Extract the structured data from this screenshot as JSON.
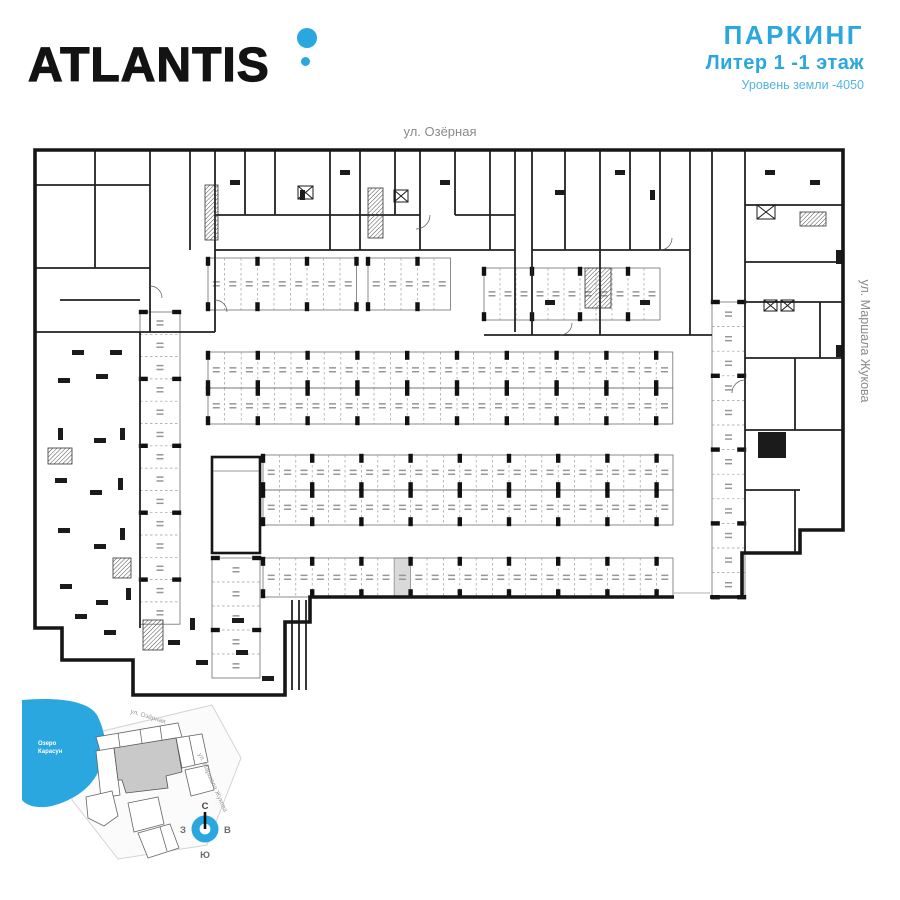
{
  "logo": {
    "text": "ATLANTIS"
  },
  "header": {
    "title": "ПАРКИНГ",
    "subtitle": "Литер 1  -1 этаж",
    "level": "Уровень земли -4050"
  },
  "plan": {
    "street_top": "ул. Озёрная",
    "street_right": "ул. Маршала Жукова",
    "stall_rows": [
      {
        "x": 208,
        "y": 258,
        "w": 16.5,
        "h": 52,
        "count": 9
      },
      {
        "x": 368,
        "y": 258,
        "w": 16.5,
        "h": 52,
        "count": 5
      },
      {
        "x": 484,
        "y": 268,
        "w": 16.0,
        "h": 52,
        "count": 11
      },
      {
        "x": 208,
        "y": 352,
        "w": 16.6,
        "h": 36,
        "count": 28
      },
      {
        "x": 208,
        "y": 388,
        "w": 16.6,
        "h": 36,
        "count": 28
      },
      {
        "x": 263,
        "y": 455,
        "w": 16.4,
        "h": 35,
        "count": 25
      },
      {
        "x": 263,
        "y": 490,
        "w": 16.4,
        "h": 35,
        "count": 25
      },
      {
        "x": 263,
        "y": 558,
        "w": 16.4,
        "h": 39,
        "count": 25,
        "highlight": 8
      },
      {
        "x": 140,
        "y": 312,
        "w": 40,
        "h": 22.3,
        "count": 14,
        "orient": "h"
      },
      {
        "x": 712,
        "y": 302,
        "w": 33,
        "h": 24.6,
        "count": 12,
        "orient": "h"
      },
      {
        "x": 212,
        "y": 558,
        "w": 48,
        "h": 24,
        "count": 5,
        "orient": "h"
      }
    ]
  },
  "minimap": {
    "lake_name_line1": "Озеро",
    "lake_name_line2": "Карасун",
    "street_top": "ул. Озёрная",
    "street_right": "ул. Маршала Жукова"
  },
  "compass": {
    "north": "С",
    "south": "Ю",
    "west": "З",
    "east": "В"
  },
  "colors": {
    "accent": "#2AA7DF",
    "accent_light": "#54B3E3",
    "wall": "#1b1b1b",
    "highlight": "#d9d9d9",
    "street_text": "#8a8a8a"
  }
}
